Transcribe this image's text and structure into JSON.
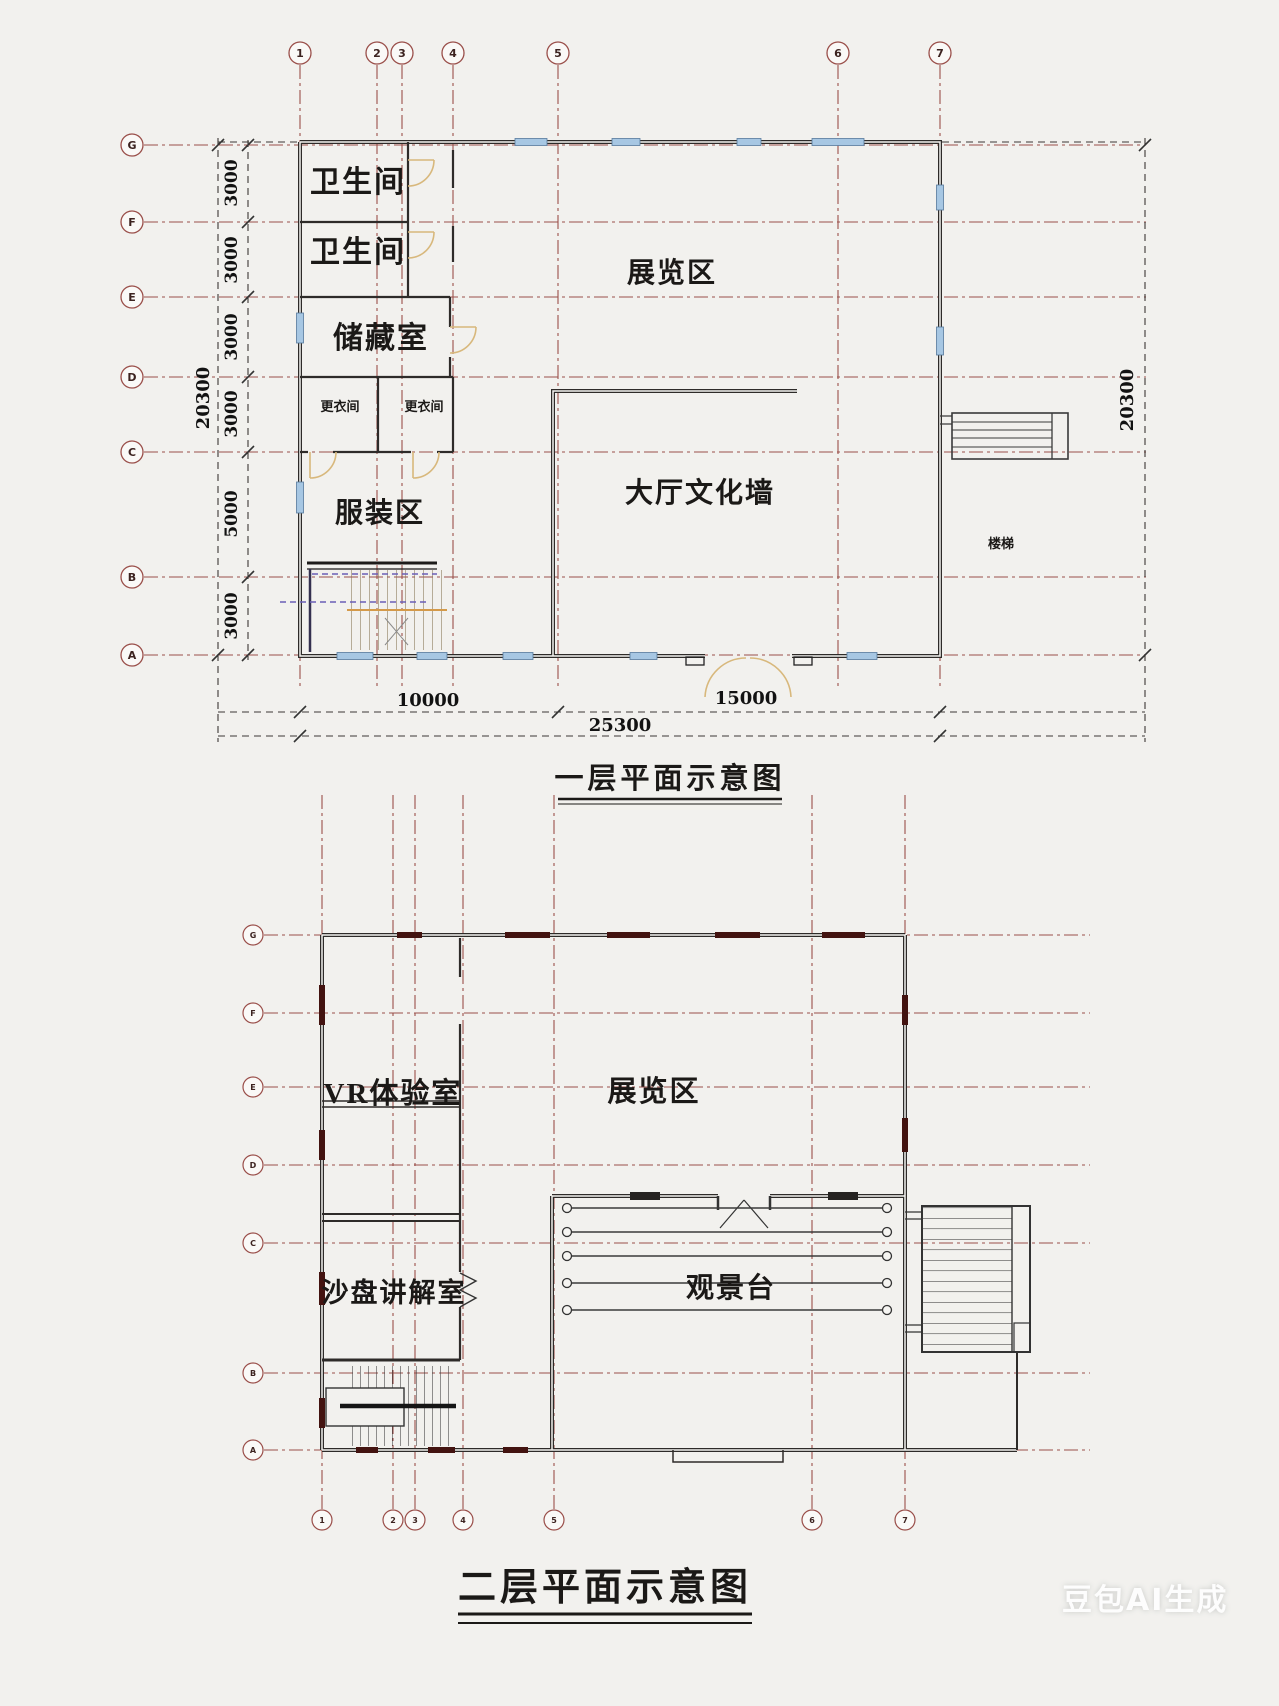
{
  "plan1": {
    "title": "一层平面示意图",
    "grid": {
      "top": [
        "1",
        "2",
        "3",
        "4",
        "5",
        "6",
        "7"
      ],
      "left": [
        "G",
        "F",
        "E",
        "D",
        "C",
        "B",
        "A"
      ]
    },
    "dims": {
      "left": [
        "3000",
        "3000",
        "3000",
        "3000",
        "5000",
        "3000"
      ],
      "left_total": "20300",
      "right_total": "20300",
      "bottom_left": "10000",
      "bottom_right": "15000",
      "bottom_total": "25300"
    },
    "rooms": {
      "toilet_1": "卫生间",
      "toilet_2": "卫生间",
      "storage": "储藏室",
      "changing_1": "更衣间",
      "changing_2": "更衣间",
      "clothing": "服装区",
      "exhibition": "展览区",
      "hall": "大厅文化墙",
      "stairs": "楼梯"
    }
  },
  "plan2": {
    "title": "二层平面示意图",
    "grid": {
      "left": [
        "G",
        "F",
        "E",
        "D",
        "C",
        "B",
        "A"
      ],
      "bottom": [
        "1",
        "2",
        "3",
        "4",
        "5",
        "6",
        "7"
      ]
    },
    "rooms": {
      "vr": "VR体验室",
      "exhibition": "展览区",
      "sandtable": "沙盘讲解室",
      "viewing": "观景台"
    }
  },
  "watermark": "豆包AI生成"
}
